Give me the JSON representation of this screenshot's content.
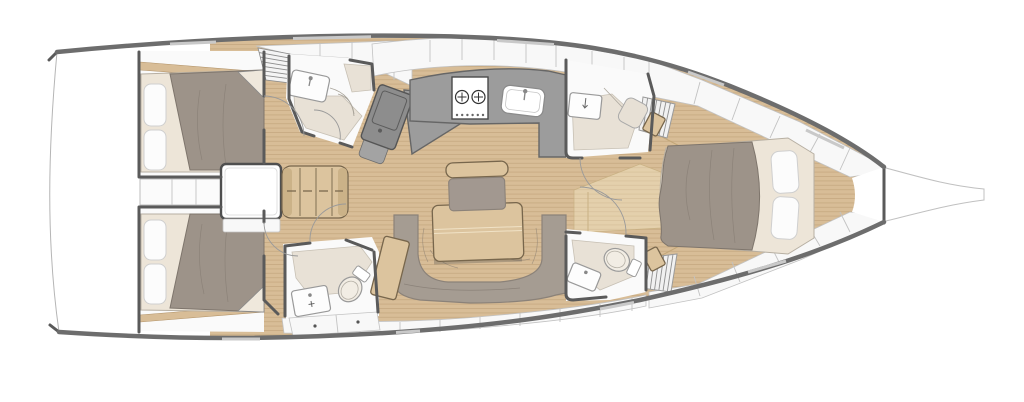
{
  "image_type": "sailing-yacht-interior-floor-plan",
  "orientation": {
    "bow": "right",
    "stern": "left",
    "view": "top-down"
  },
  "palette": {
    "bg": "#ffffff",
    "hull_wall": "#6d6d6d",
    "window": "#c9c9c9",
    "outline": "#b5b5b5",
    "floor_wood": "#d8bd97",
    "floor_plank_line": "#b3946a",
    "wood_furniture": "#dcc49e",
    "wood_dark_edge": "#77664c",
    "step_wood": "#e4d0ac",
    "duvet": "#9d9389",
    "duvet_line": "#7e756c",
    "mattress": "#ede5d8",
    "pillow": "#fcfcfc",
    "settee": "#a59c92",
    "counter_gray": "#9c9c9c",
    "counter_edge": "#666666",
    "desk_gray": "#8d8d8d",
    "head_floor": "#e8e1d6",
    "fixture_white": "#fdfdfd",
    "fixture_edge": "#999999",
    "cabinet_white": "#f8f8f8",
    "cabinet_line": "#c2c2c2",
    "wall_dark": "#5a5a5a"
  },
  "rooms": [
    {
      "id": "aft-cabin-starboard",
      "fixtures": [
        "double-bed",
        "two-pillows",
        "duvet",
        "hull-shelf"
      ]
    },
    {
      "id": "aft-cabin-port",
      "fixtures": [
        "double-bed",
        "two-pillows",
        "duvet",
        "hull-shelf"
      ]
    },
    {
      "id": "engine-compartment",
      "fixtures": [
        "companionway-box",
        "shelf-lockers"
      ]
    },
    {
      "id": "companionway-stairs",
      "fixtures": [
        "steps"
      ]
    },
    {
      "id": "aft-head-shower",
      "fixtures": [
        "sink-basin",
        "shower-seat",
        "door-swing"
      ]
    },
    {
      "id": "nav-station",
      "fixtures": [
        "chart-desk",
        "seat"
      ]
    },
    {
      "id": "galley",
      "fixtures": [
        "two-burner-stove",
        "sink-basin",
        "counter",
        "overhead-lockers"
      ]
    },
    {
      "id": "saloon",
      "fixtures": [
        "u-shaped-settee",
        "dining-table",
        "slatted-bench",
        "chair",
        "side-table"
      ]
    },
    {
      "id": "mid-head-port",
      "fixtures": [
        "toilet",
        "sink-basin",
        "vanity-cabinet",
        "door-swing"
      ]
    },
    {
      "id": "forward-head-upper",
      "fixtures": [
        "sink-basin",
        "hanging-locker",
        "door-swing"
      ]
    },
    {
      "id": "forward-head-lower",
      "fixtures": [
        "toilet",
        "sink-basin",
        "hanging-locker",
        "door-swing"
      ]
    },
    {
      "id": "forward-cabin",
      "fixtures": [
        "island-double-bed",
        "two-pillows",
        "duvet",
        "side-seats",
        "hull-lockers",
        "entry-step"
      ]
    },
    {
      "id": "bow",
      "fixtures": [
        "anchor-bulkhead",
        "bowsprit"
      ]
    }
  ]
}
